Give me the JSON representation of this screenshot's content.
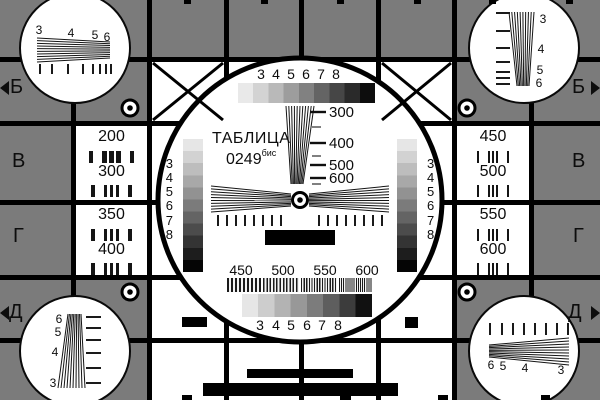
{
  "colors": {
    "background": "#7b7b7b",
    "grid_line": "#000000",
    "panel_white": "#ffffff",
    "ink": "#0d0d0d"
  },
  "title": {
    "name": "ТАБЛИЦА",
    "number": "0249",
    "suffix": "бис"
  },
  "row_markers": {
    "top_left": "Б",
    "top_right": "Б",
    "mid_upper_left": "В",
    "mid_upper_right": "В",
    "mid_lower_left": "Г",
    "mid_lower_right": "Г",
    "bottom_left": "Д",
    "bottom_right": "Д"
  },
  "center_circle": {
    "top_step_labels": [
      "3",
      "4",
      "5",
      "6",
      "7",
      "8"
    ],
    "bottom_step_labels": [
      "3",
      "4",
      "5",
      "6",
      "7",
      "8"
    ],
    "left_step_labels": [
      "3",
      "4",
      "5",
      "6",
      "7",
      "8"
    ],
    "right_step_labels": [
      "3",
      "4",
      "5",
      "6",
      "7",
      "8"
    ],
    "wedge_scale": [
      "300",
      "400",
      "500",
      "600"
    ],
    "burst_scale": [
      "450",
      "500",
      "550",
      "600"
    ],
    "grayscale_steps_top": [
      "#e9e9e9",
      "#d3d3d3",
      "#b9b9b9",
      "#9d9d9d",
      "#818181",
      "#646464",
      "#464646",
      "#2a2a2a",
      "#0d0d0d"
    ],
    "grayscale_steps_side": [
      "#e6e6e6",
      "#d2d2d2",
      "#bdbdbd",
      "#a8a8a8",
      "#929292",
      "#7b7b7b",
      "#646464",
      "#4c4c4c",
      "#343434",
      "#1d1d1d",
      "#050505"
    ],
    "grayscale_steps_bottom": [
      "#e6e6e6",
      "#cdcdcd",
      "#b3b3b3",
      "#989898",
      "#7c7c7c",
      "#5e5e5e",
      "#3c3c3c",
      "#111111"
    ]
  },
  "left_column": {
    "values": [
      "200",
      "300",
      "350",
      "400"
    ]
  },
  "right_column": {
    "values": [
      "450",
      "500",
      "550",
      "600"
    ]
  },
  "corner_circles": {
    "top_left": {
      "labels": [
        "3",
        "4",
        "5",
        "6"
      ]
    },
    "top_right": {
      "labels": [
        "3",
        "4",
        "5",
        "6"
      ]
    },
    "bottom_left": {
      "labels": [
        "6",
        "5",
        "4",
        "3"
      ]
    },
    "bottom_right": {
      "labels": [
        "6",
        "5",
        "4",
        "3"
      ]
    }
  }
}
